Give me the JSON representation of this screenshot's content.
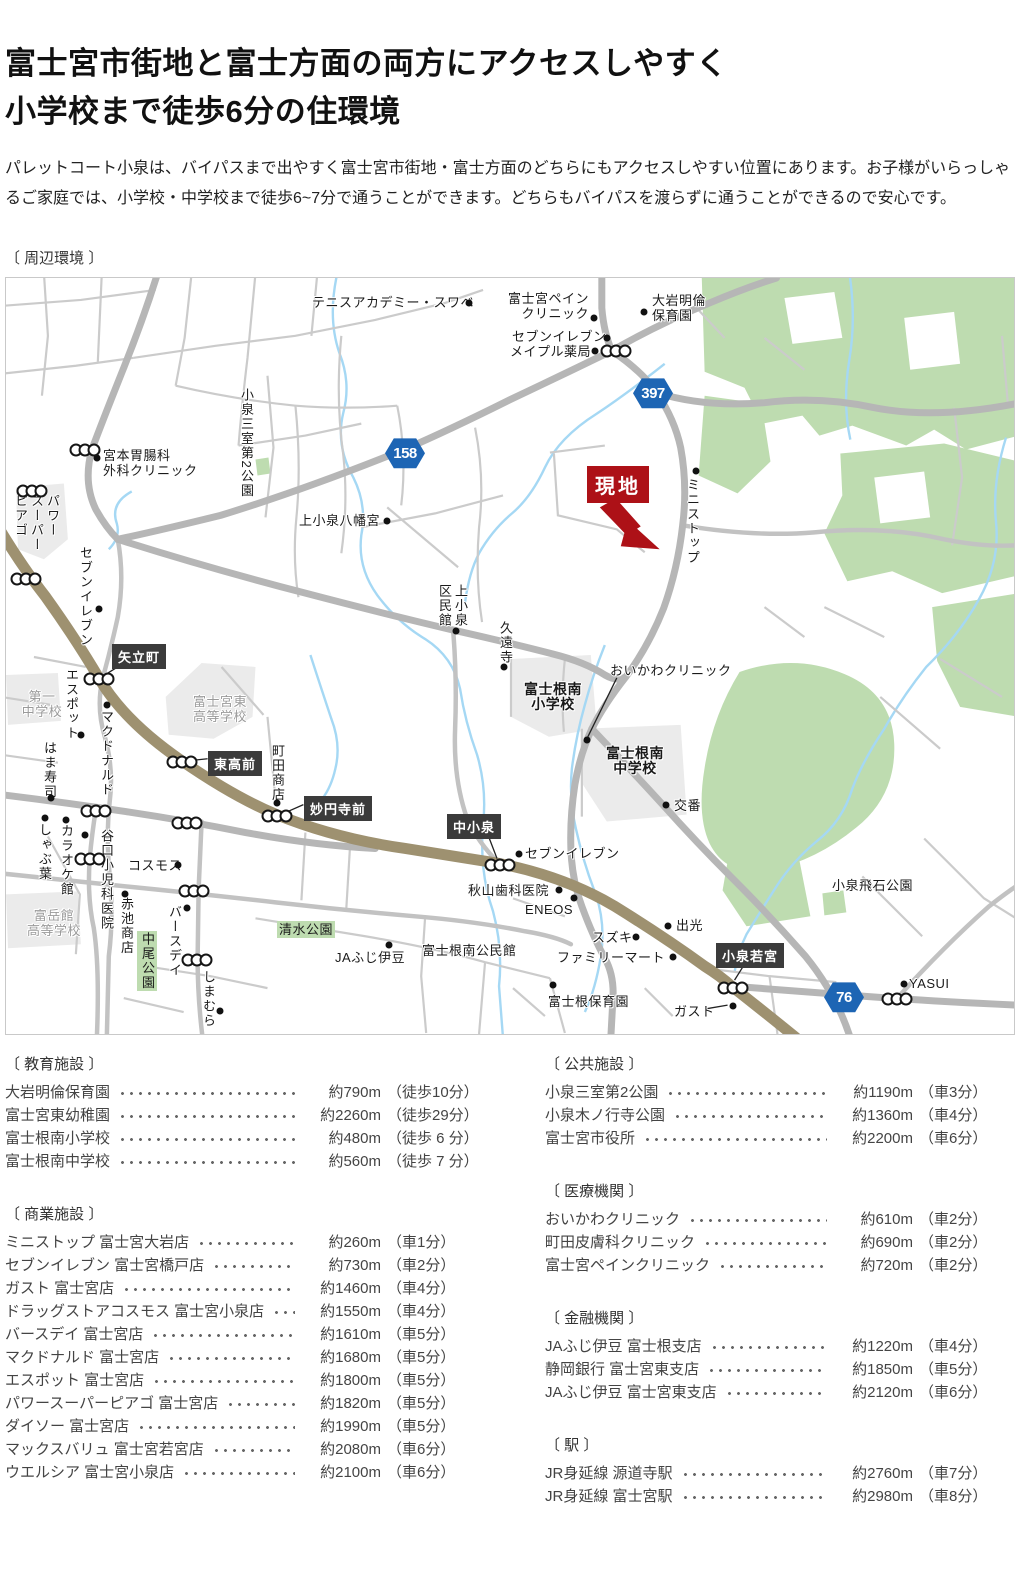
{
  "header": {
    "title_line1": "富士宮市街地と富士方面の両方にアクセスしやすく",
    "title_line2": "小学校まで徒歩6分の住環境",
    "paragraph": "パレットコート小泉は、バイパスまで出やすく富士宮市街地・富士方面のどちらにもアクセスしやすい位置にあります。お子様がいらっしゃるご家庭では、小学校・中学校まで徒歩6~7分で通うことができます。どちらもバイパスを渡らずに通うことができるので安心です。",
    "section_label": "〔 周辺環境 〕"
  },
  "map": {
    "colors": {
      "site_red": "#ad1117",
      "shield_blue": "#1d65b4",
      "intersection_box": "#3b3b3b",
      "main_road_brown": "#9e9170",
      "park_green": "#bedcb0",
      "river_blue": "#a5d8f4"
    },
    "site": {
      "label": "現地",
      "x": 581,
      "y": 188
    },
    "shields": [
      {
        "n": "158",
        "x": 399,
        "y": 175
      },
      {
        "n": "397",
        "x": 647,
        "y": 115
      },
      {
        "n": "76",
        "x": 838,
        "y": 719
      }
    ],
    "iboxes": [
      {
        "t": "矢立町",
        "x": 106,
        "y": 366
      },
      {
        "t": "東高前",
        "x": 202,
        "y": 473
      },
      {
        "t": "妙円寺前",
        "x": 298,
        "y": 518
      },
      {
        "t": "中小泉",
        "x": 441,
        "y": 536
      },
      {
        "t": "小泉若宮",
        "x": 710,
        "y": 665
      }
    ],
    "labels": [
      {
        "t": "テニスアカデミー・スワベ",
        "x": 306,
        "y": 17
      },
      {
        "t": "富士宮ペイン\nクリニック",
        "x": 498,
        "y": 13,
        "c": "r",
        "w": 85
      },
      {
        "t": "大岩明倫\n保育園",
        "x": 646,
        "y": 15
      },
      {
        "t": "セブンイレブン",
        "x": 506,
        "y": 51
      },
      {
        "t": "メイプル薬局",
        "x": 504,
        "y": 66
      },
      {
        "t": "宮本胃腸科\n外科クリニック",
        "x": 97,
        "y": 170
      },
      {
        "t": "上小泉八幡宮",
        "x": 293,
        "y": 235
      },
      {
        "t": "おいかわクリニック",
        "x": 604,
        "y": 385
      },
      {
        "t": "交番",
        "x": 668,
        "y": 520
      },
      {
        "t": "セブンイレブン",
        "x": 519,
        "y": 568
      },
      {
        "t": "秋山歯科医院",
        "x": 462,
        "y": 605
      },
      {
        "t": "ENEOS",
        "x": 519,
        "y": 624
      },
      {
        "t": "スズキ",
        "x": 586,
        "y": 652
      },
      {
        "t": "出光",
        "x": 670,
        "y": 640
      },
      {
        "t": "ファミリーマート",
        "x": 551,
        "y": 672
      },
      {
        "t": "富士根保育園",
        "x": 542,
        "y": 716
      },
      {
        "t": "ガスト",
        "x": 668,
        "y": 726
      },
      {
        "t": "YASUI",
        "x": 903,
        "y": 698
      },
      {
        "t": "小泉飛石公園",
        "x": 826,
        "y": 600
      },
      {
        "t": "JAふじ伊豆",
        "x": 329,
        "y": 672
      },
      {
        "t": "富士根南公民館",
        "x": 416,
        "y": 665
      },
      {
        "t": "コスモス",
        "x": 122,
        "y": 580
      },
      {
        "t": "清水公園",
        "x": 271,
        "y": 643,
        "c": "greenbg"
      },
      {
        "t": "第一\n中学校",
        "x": 8,
        "y": 411,
        "c": "gray c",
        "w": 56
      },
      {
        "t": "富士宮東\n高等学校",
        "x": 182,
        "y": 416,
        "c": "gray c",
        "w": 64
      },
      {
        "t": "富岳館\n高等学校",
        "x": 18,
        "y": 630,
        "c": "gray c",
        "w": 60
      },
      {
        "t": "富士根南\n小学校",
        "x": 514,
        "y": 404,
        "c": "sch",
        "w": 66
      },
      {
        "t": "富士根南\n中学校",
        "x": 594,
        "y": 468,
        "c": "sch",
        "w": 70
      },
      {
        "t": "ミニストップ",
        "x": 678,
        "y": 200,
        "c": "v"
      },
      {
        "t": "小泉三室第2公園",
        "x": 232,
        "y": 110,
        "c": "v"
      },
      {
        "t": "パワー\nスーパー\nピアゴ",
        "x": 6,
        "y": 216,
        "c": "v"
      },
      {
        "t": "セブンイレブン",
        "x": 71,
        "y": 268,
        "c": "v"
      },
      {
        "t": "エスポット",
        "x": 57,
        "y": 390,
        "c": "v"
      },
      {
        "t": "マクドナルド",
        "x": 92,
        "y": 432,
        "c": "v"
      },
      {
        "t": "はま寿司",
        "x": 35,
        "y": 463,
        "c": "v"
      },
      {
        "t": "しゃぶ葉",
        "x": 30,
        "y": 545,
        "c": "v"
      },
      {
        "t": "カラオケ館",
        "x": 52,
        "y": 546,
        "c": "v"
      },
      {
        "t": "谷口小児科医院",
        "x": 92,
        "y": 551,
        "c": "v"
      },
      {
        "t": "赤池商店",
        "x": 112,
        "y": 619,
        "c": "v"
      },
      {
        "t": "バースデイ",
        "x": 160,
        "y": 627,
        "c": "v"
      },
      {
        "t": "中尾公園",
        "x": 131,
        "y": 653,
        "c": "v greenbg"
      },
      {
        "t": "しまむら",
        "x": 194,
        "y": 692,
        "c": "v"
      },
      {
        "t": "町田商店",
        "x": 263,
        "y": 466,
        "c": "v"
      },
      {
        "t": "上小泉\n区民館",
        "x": 430,
        "y": 306,
        "c": "v"
      },
      {
        "t": "久遠寺",
        "x": 491,
        "y": 343,
        "c": "v"
      }
    ],
    "dots": [
      [
        463,
        25
      ],
      [
        588,
        40
      ],
      [
        638,
        34
      ],
      [
        601,
        60
      ],
      [
        589,
        73
      ],
      [
        91,
        180
      ],
      [
        381,
        243
      ],
      [
        690,
        193
      ],
      [
        93,
        331
      ],
      [
        75,
        457
      ],
      [
        101,
        427
      ],
      [
        45,
        520
      ],
      [
        39,
        540
      ],
      [
        60,
        542
      ],
      [
        79,
        557
      ],
      [
        172,
        587
      ],
      [
        119,
        616
      ],
      [
        181,
        630
      ],
      [
        214,
        733
      ],
      [
        271,
        525
      ],
      [
        450,
        353
      ],
      [
        498,
        389
      ],
      [
        581,
        462
      ],
      [
        660,
        527
      ],
      [
        513,
        576
      ],
      [
        553,
        612
      ],
      [
        568,
        620
      ],
      [
        630,
        659
      ],
      [
        662,
        648
      ],
      [
        667,
        679
      ],
      [
        547,
        707
      ],
      [
        727,
        728
      ],
      [
        898,
        706
      ],
      [
        383,
        667
      ]
    ],
    "lights": [
      [
        610,
        73
      ],
      [
        79,
        172
      ],
      [
        26,
        213
      ],
      [
        20,
        301
      ],
      [
        93,
        401
      ],
      [
        176,
        484
      ],
      [
        271,
        538
      ],
      [
        90,
        533
      ],
      [
        181,
        545
      ],
      [
        84,
        581
      ],
      [
        188,
        613
      ],
      [
        191,
        682
      ],
      [
        494,
        587
      ],
      [
        727,
        710
      ],
      [
        891,
        721
      ]
    ]
  },
  "facilities": {
    "left": [
      {
        "title": "〔 教育施設 〕",
        "items": [
          {
            "name": "大岩明倫保育園",
            "dist": "約790m",
            "time": "（徒歩10分）"
          },
          {
            "name": "富士宮東幼稚園",
            "dist": "約2260m",
            "time": "（徒歩29分）"
          },
          {
            "name": "富士根南小学校",
            "dist": "約480m",
            "time": "（徒歩 6 分）"
          },
          {
            "name": "富士根南中学校",
            "dist": "約560m",
            "time": "（徒歩 7 分）"
          }
        ]
      },
      {
        "title": "〔 商業施設 〕",
        "items": [
          {
            "name": "ミニストップ 富士宮大岩店",
            "dist": "約260m",
            "time": "（車1分）"
          },
          {
            "name": "セブンイレブン 富士宮橋戸店",
            "dist": "約730m",
            "time": "（車2分）"
          },
          {
            "name": "ガスト 富士宮店",
            "dist": "約1460m",
            "time": "（車4分）"
          },
          {
            "name": "ドラッグストアコスモス 富士宮小泉店",
            "dist": "約1550m",
            "time": "（車4分）"
          },
          {
            "name": "バースデイ 富士宮店",
            "dist": "約1610m",
            "time": "（車5分）"
          },
          {
            "name": "マクドナルド 富士宮店",
            "dist": "約1680m",
            "time": "（車5分）"
          },
          {
            "name": "エスポット 富士宮店",
            "dist": "約1800m",
            "time": "（車5分）"
          },
          {
            "name": "パワースーパーピアゴ 富士宮店",
            "dist": "約1820m",
            "time": "（車5分）"
          },
          {
            "name": "ダイソー 富士宮店",
            "dist": "約1990m",
            "time": "（車5分）"
          },
          {
            "name": "マックスバリュ 富士宮若宮店",
            "dist": "約2080m",
            "time": "（車6分）"
          },
          {
            "name": "ウエルシア 富士宮小泉店",
            "dist": "約2100m",
            "time": "（車6分）"
          }
        ]
      }
    ],
    "right": [
      {
        "title": "〔 公共施設 〕",
        "items": [
          {
            "name": "小泉三室第2公園",
            "dist": "約1190m",
            "time": "（車3分）"
          },
          {
            "name": "小泉木ノ行寺公園",
            "dist": "約1360m",
            "time": "（車4分）"
          },
          {
            "name": "富士宮市役所",
            "dist": "約2200m",
            "time": "（車6分）"
          }
        ]
      },
      {
        "title": "〔 医療機関 〕",
        "items": [
          {
            "name": "おいかわクリニック",
            "dist": "約610m",
            "time": "（車2分）"
          },
          {
            "name": "町田皮膚科クリニック",
            "dist": "約690m",
            "time": "（車2分）"
          },
          {
            "name": "富士宮ペインクリニック",
            "dist": "約720m",
            "time": "（車2分）"
          }
        ]
      },
      {
        "title": "〔 金融機関 〕",
        "items": [
          {
            "name": "JAふじ伊豆 富士根支店",
            "dist": "約1220m",
            "time": "（車4分）"
          },
          {
            "name": "静岡銀行 富士宮東支店",
            "dist": "約1850m",
            "time": "（車5分）"
          },
          {
            "name": "JAふじ伊豆 富士宮東支店",
            "dist": "約2120m",
            "time": "（車6分）"
          }
        ]
      },
      {
        "title": "〔 駅 〕",
        "items": [
          {
            "name": "JR身延線 源道寺駅",
            "dist": "約2760m",
            "time": "（車7分）"
          },
          {
            "name": "JR身延線 富士宮駅",
            "dist": "約2980m",
            "time": "（車8分）"
          }
        ]
      }
    ]
  }
}
